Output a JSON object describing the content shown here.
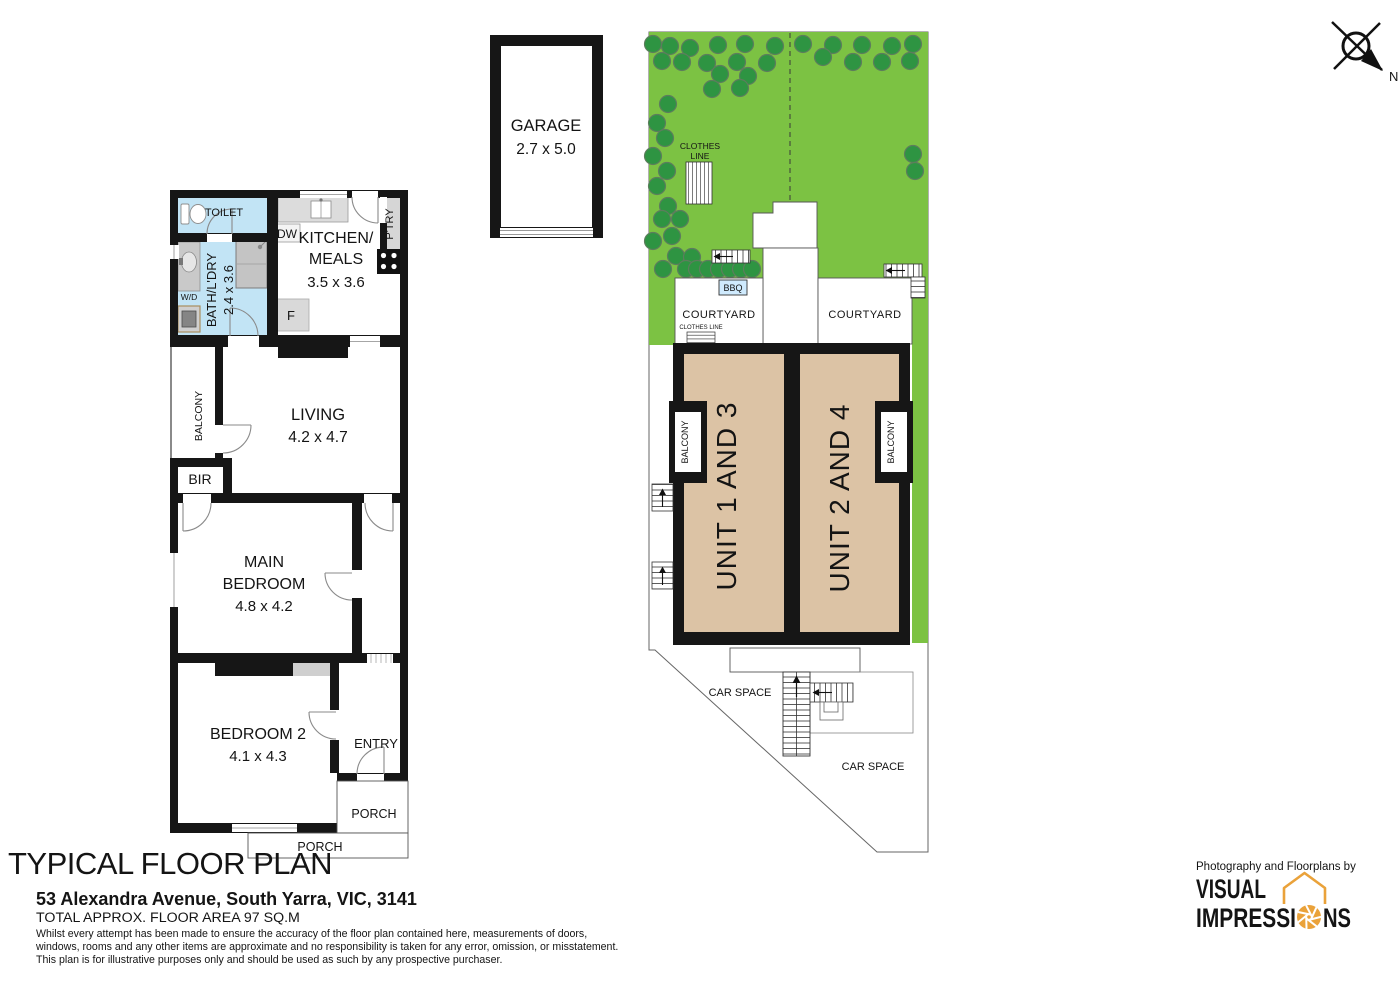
{
  "plan": {
    "toilet": {
      "label": "TOILET"
    },
    "bath": {
      "label": "BATH/L'DRY",
      "dims": "2.4 x 3.6"
    },
    "dishwasher": {
      "label": "DW"
    },
    "washer": {
      "label": "W/D"
    },
    "kitchen": {
      "label1": "KITCHEN/",
      "label2": "MEALS",
      "dims": "3.5 x 3.6"
    },
    "pantry": {
      "label": "P'TRY"
    },
    "fridge": {
      "label": "F"
    },
    "balcony": {
      "label": "BALCONY"
    },
    "living": {
      "label": "LIVING",
      "dims": "4.2 x 4.7"
    },
    "bir": {
      "label": "BIR"
    },
    "main_bedroom": {
      "label1": "MAIN",
      "label2": "BEDROOM",
      "dims": "4.8 x 4.2"
    },
    "bedroom2": {
      "label": "BEDROOM 2",
      "dims": "4.1 x 4.3"
    },
    "entry": {
      "label": "ENTRY"
    },
    "porch_side": {
      "label": "PORCH"
    },
    "porch_bottom": {
      "label": "PORCH"
    }
  },
  "garage": {
    "label": "GARAGE",
    "dims": "2.7 x 5.0"
  },
  "site": {
    "clothes_line_garden": {
      "label1": "CLOTHES",
      "label2": "LINE"
    },
    "bbq": {
      "label": "BBQ"
    },
    "courtyard_left": {
      "label": "COURTYARD"
    },
    "courtyard_right": {
      "label": "COURTYARD"
    },
    "clothes_line_courtyard": {
      "label": "CLOTHES LINE"
    },
    "unit_1_3": {
      "label": "UNIT 1 AND 3"
    },
    "unit_2_4": {
      "label": "UNIT 2 AND 4"
    },
    "balcony_left": {
      "label": "BALCONY"
    },
    "balcony_right": {
      "label": "BALCONY"
    },
    "car_space_left": {
      "label": "CAR SPACE"
    },
    "car_space_right": {
      "label": "CAR SPACE"
    },
    "trees": [
      [
        653,
        44
      ],
      [
        670,
        46
      ],
      [
        690,
        48
      ],
      [
        718,
        45
      ],
      [
        745,
        44
      ],
      [
        775,
        46
      ],
      [
        803,
        44
      ],
      [
        833,
        45
      ],
      [
        862,
        45
      ],
      [
        892,
        46
      ],
      [
        913,
        44
      ],
      [
        662,
        61
      ],
      [
        682,
        62
      ],
      [
        707,
        63
      ],
      [
        737,
        62
      ],
      [
        767,
        63
      ],
      [
        823,
        57
      ],
      [
        853,
        62
      ],
      [
        882,
        62
      ],
      [
        910,
        61
      ],
      [
        720,
        74
      ],
      [
        748,
        76
      ],
      [
        712,
        89
      ],
      [
        740,
        88
      ],
      [
        668,
        104
      ],
      [
        657,
        123
      ],
      [
        665,
        138
      ],
      [
        653,
        156
      ],
      [
        667,
        171
      ],
      [
        657,
        186
      ],
      [
        668,
        206
      ],
      [
        662,
        219
      ],
      [
        680,
        219
      ],
      [
        672,
        236
      ],
      [
        653,
        241
      ],
      [
        676,
        256
      ],
      [
        692,
        257
      ],
      [
        913,
        154
      ],
      [
        915,
        171
      ],
      [
        663,
        269
      ],
      [
        686,
        269
      ],
      [
        697,
        269
      ],
      [
        708,
        269
      ],
      [
        719,
        269
      ],
      [
        730,
        269
      ],
      [
        741,
        269
      ],
      [
        752,
        269
      ]
    ]
  },
  "compass": {
    "label": "N"
  },
  "footer": {
    "title": "TYPICAL FLOOR PLAN",
    "address": "53 Alexandra Avenue, South Yarra, VIC, 3141",
    "area": "TOTAL APPROX. FLOOR AREA 97 SQ.M",
    "disclaimer": [
      "Whilst every attempt has been made to ensure the accuracy of the floor plan contained here, measurements of doors,",
      "windows, rooms and any other items are approximate and no responsibility is taken for any error, omission, or misstatement.",
      "This plan is for illustrative purposes only and should be used as such by any prospective purchaser."
    ]
  },
  "branding": {
    "tagline": "Photography and Floorplans by",
    "name1": "VISUAL",
    "name2a": "IMPRESSI",
    "name2b": "NS"
  },
  "colors": {
    "grass": "#7cc243",
    "tree": "#2e9442",
    "unit_fill": "#dcc3a5",
    "wet_area": "#c2e4f5",
    "wall": "#161616",
    "bbq_fill": "#cfeafd",
    "brand_orange": "#eaa23a",
    "brand_gray": "#54555a"
  }
}
